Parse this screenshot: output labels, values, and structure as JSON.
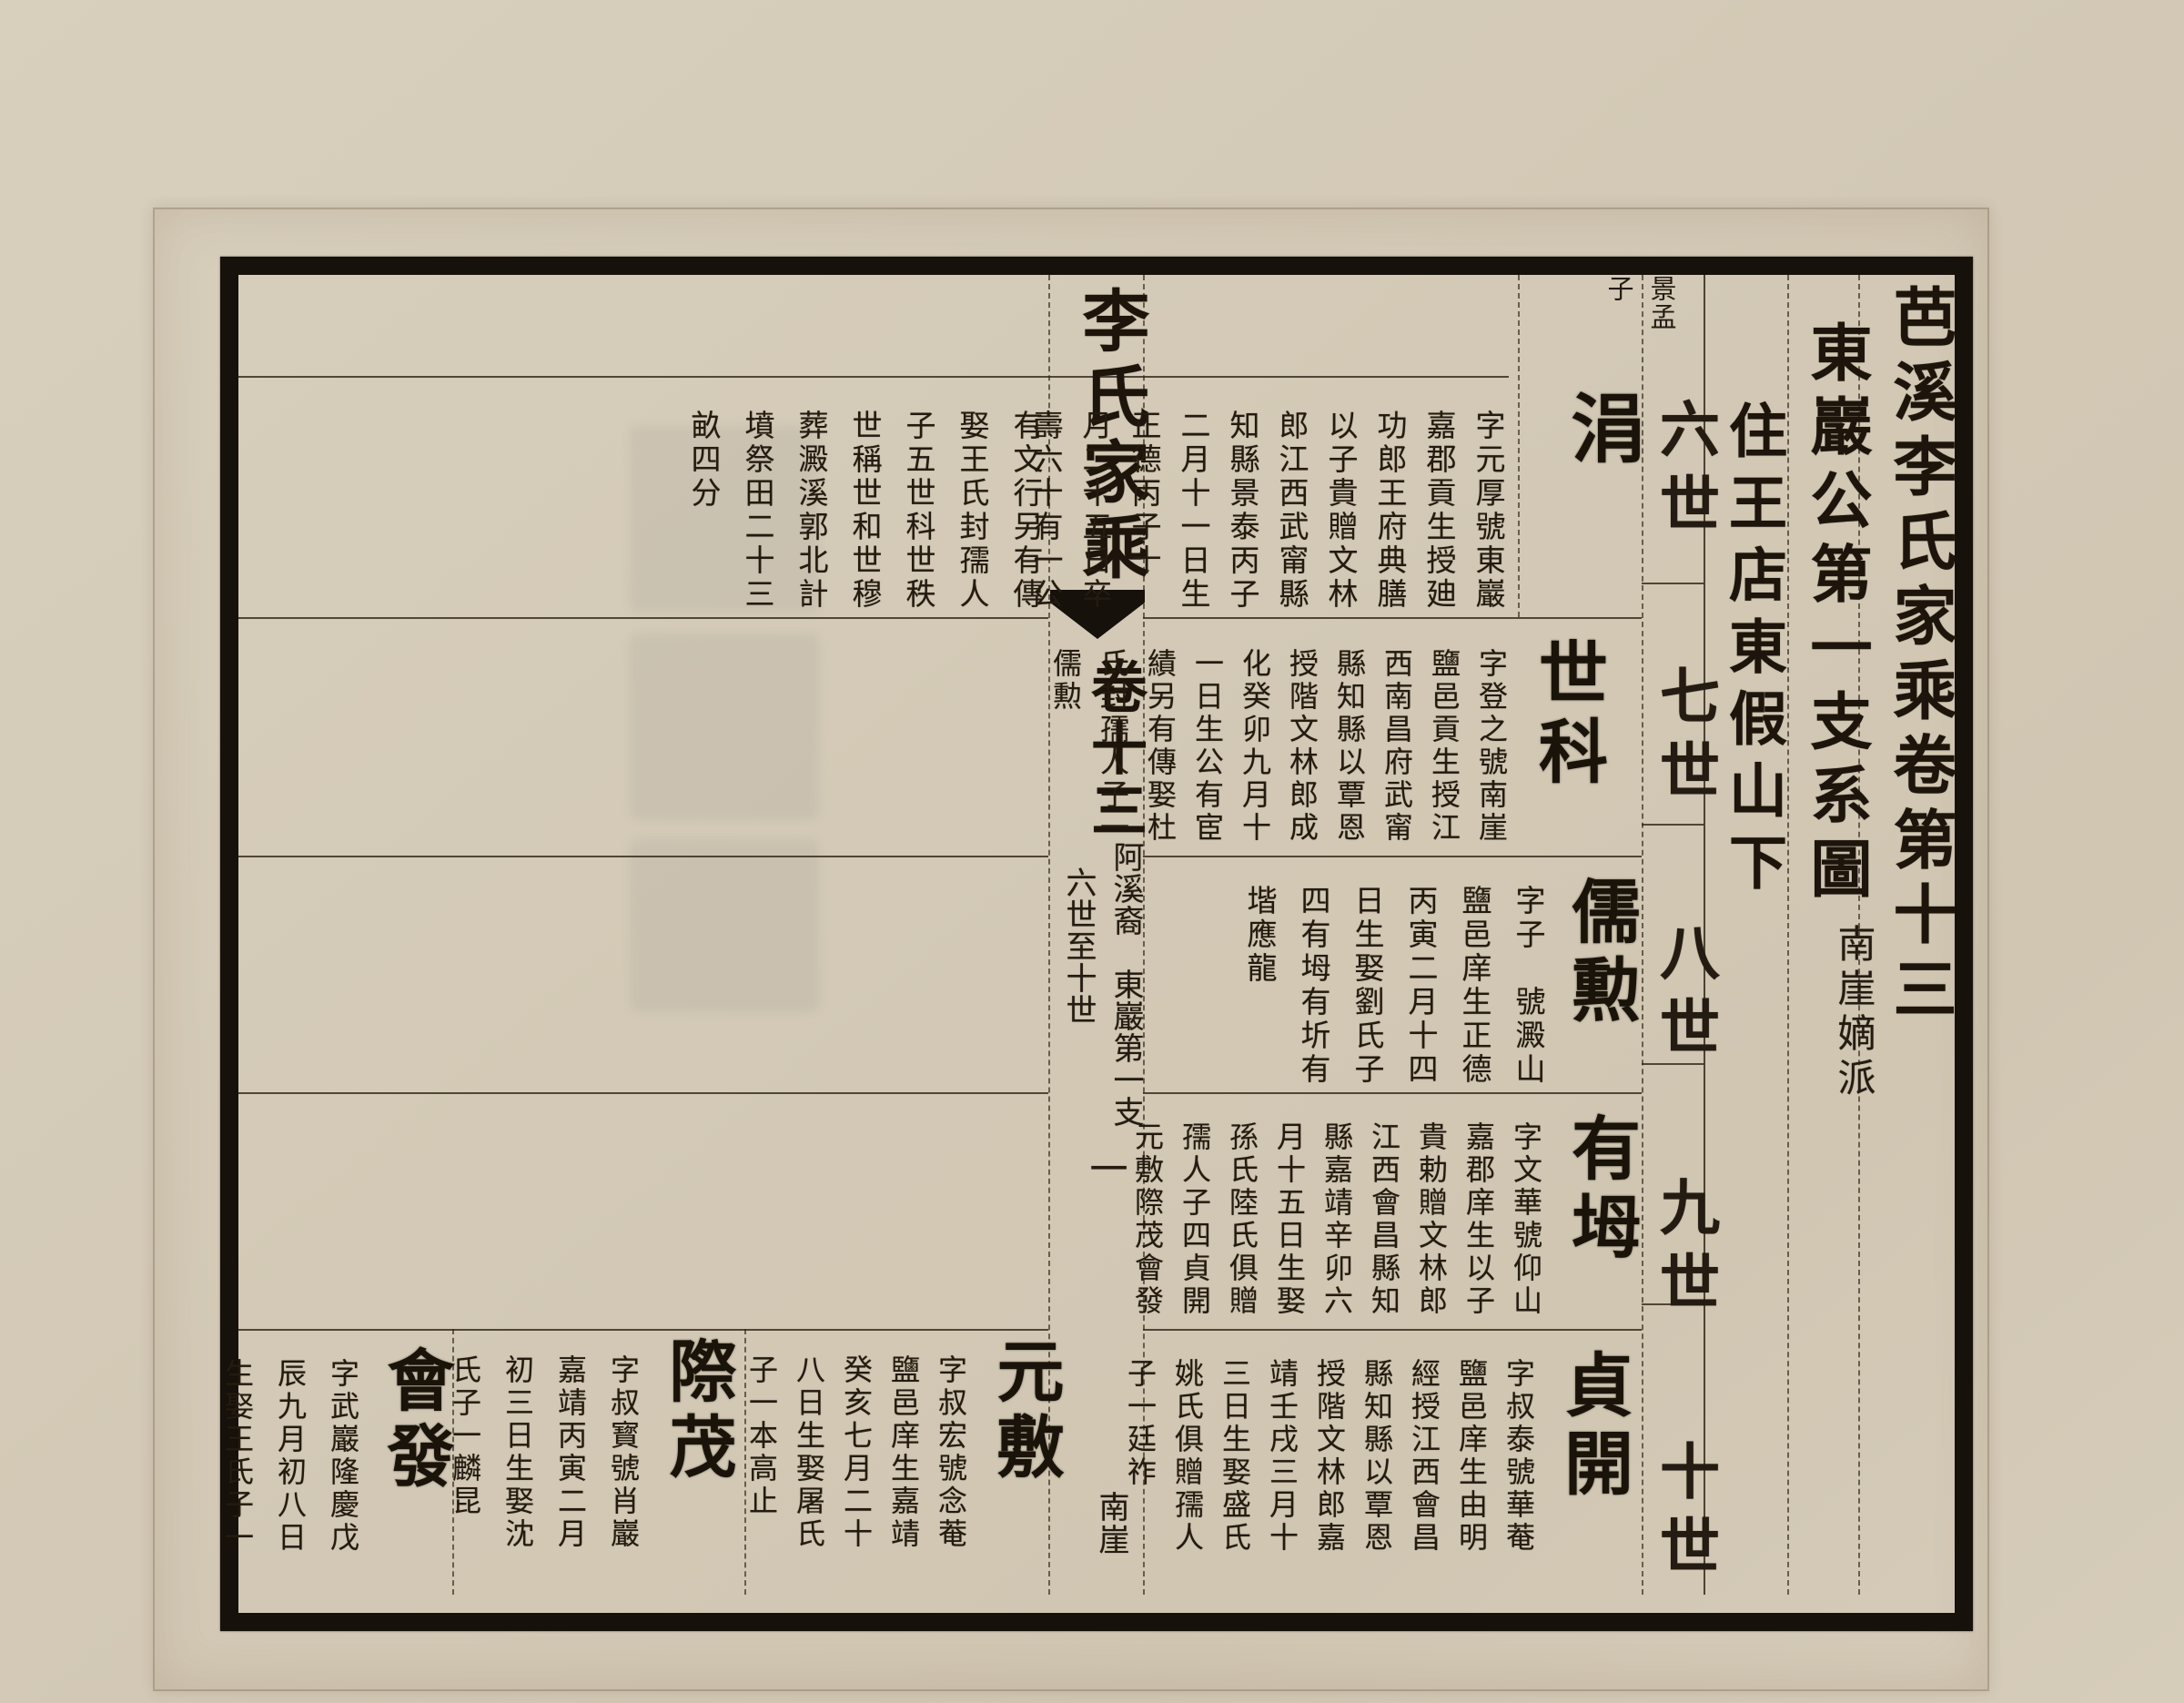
{
  "colors": {
    "paper": "#d3c9b6",
    "ink": "#241c12",
    "frame": "#17110b"
  },
  "page": {
    "title_column": "芭溪李氏家乘卷第十三",
    "branch_column": "東巖公第一支系圖",
    "branch_subnote": "南崖嫡派",
    "residence_column": "住王店東假山下",
    "generation_labels": [
      "六世",
      "七世",
      "八世",
      "九世",
      "十世"
    ]
  },
  "spine": {
    "book_title": "李氏家乘",
    "volume": "卷十三",
    "branch_note": "阿溪裔　東巖第一支",
    "generation_range": "六世至十世",
    "page_number": "一",
    "bottom_note": "南崖"
  },
  "entries": [
    {
      "generation": "六世",
      "name": "涓",
      "parent_note": {
        "name": "景孟",
        "suffix": "子"
      },
      "bio": [
        "字元厚號東巖",
        "嘉郡貢生授廸",
        "功郎王府典膳",
        "以子貴贈文林",
        "郎江西武甯縣",
        "知縣景泰丙子",
        "二月十一日生",
        "正德丙子十",
        "月二十五日卒",
        "壽六十有一公"
      ],
      "bio_cont": [
        "有文行另有傳",
        "娶王氏封孺人",
        "子五世科世秩",
        "世稱世和世穆",
        "葬澱溪郭北計",
        "墳祭田二十三",
        "畝四分"
      ]
    },
    {
      "generation": "七世",
      "name": "世科",
      "bio": [
        "字登之號南崖",
        "鹽邑貢生授江",
        "西南昌府武甯",
        "縣知縣以覃恩",
        "授階文林郎成",
        "化癸卯九月十",
        "一日生公有宦",
        "績另有傳娶杜",
        "氏封孺人子一",
        "儒勲"
      ]
    },
    {
      "generation": "八世",
      "name": "儒勲",
      "bio": [
        "字子　號澱山",
        "鹽邑庠生正德",
        "丙寅二月十四",
        "日生娶劉氏子",
        "四有坶有圻有",
        "堦應龍"
      ]
    },
    {
      "generation": "九世",
      "name": "有坶",
      "bio": [
        "字文華號仰山",
        "嘉郡庠生以子",
        "貴勅贈文林郎",
        "江西會昌縣知",
        "縣嘉靖辛卯六",
        "月十五日生娶",
        "孫氏陸氏俱贈",
        "孺人子四貞開",
        "元敷際茂會發"
      ]
    },
    {
      "generation": "十世",
      "name": "貞開",
      "bio": [
        "字叔泰號華菴",
        "鹽邑庠生由明",
        "經授江西會昌",
        "縣知縣以覃恩",
        "授階文林郎嘉",
        "靖壬戌三月十",
        "三日生娶盛氏",
        "姚氏俱贈孺人",
        "子一廷祚"
      ]
    },
    {
      "generation": "十世",
      "name": "元敷",
      "bio": [
        "字叔宏號念菴",
        "鹽邑庠生嘉靖",
        "癸亥七月二十",
        "八日生娶屠氏",
        "子一本高止"
      ]
    },
    {
      "generation": "十世",
      "name": "際茂",
      "bio": [
        "字叔寳號肖巖",
        "嘉靖丙寅二月",
        "初三日生娶沈",
        "氏子一麟昆"
      ]
    },
    {
      "generation": "十世",
      "name": "會發",
      "bio": [
        "字武巖隆慶戊",
        "辰九月初八日",
        "生娶王氏子一"
      ]
    }
  ]
}
